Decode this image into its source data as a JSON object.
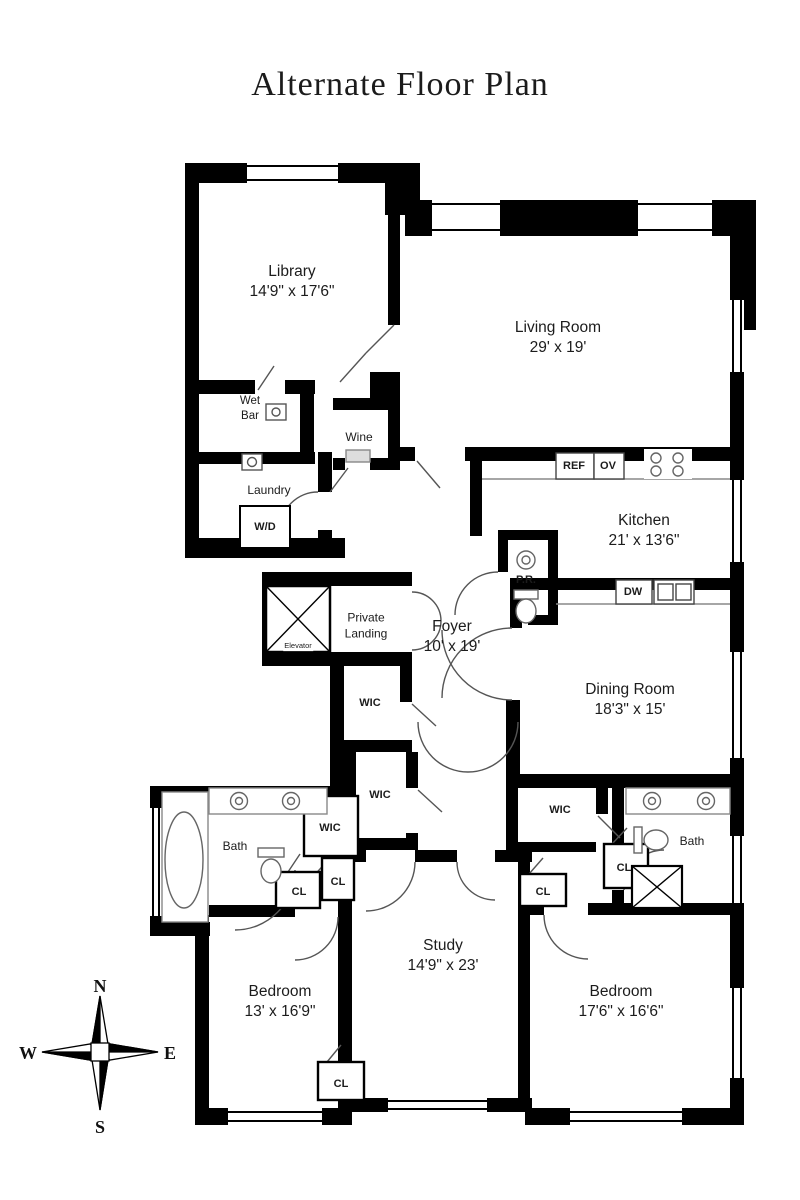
{
  "title": "Alternate Floor Plan",
  "rooms": {
    "library": {
      "name": "Library",
      "dims": "14'9\" x 17'6\""
    },
    "living_room": {
      "name": "Living Room",
      "dims": "29' x 19'"
    },
    "kitchen": {
      "name": "Kitchen",
      "dims": "21' x 13'6\""
    },
    "foyer": {
      "name": "Foyer",
      "dims": "10' x 19'"
    },
    "dining_room": {
      "name": "Dining Room",
      "dims": "18'3\" x 15'"
    },
    "study": {
      "name": "Study",
      "dims": "14'9\" x 23'"
    },
    "bedroom_left": {
      "name": "Bedroom",
      "dims": "13' x 16'9\""
    },
    "bedroom_right": {
      "name": "Bedroom",
      "dims": "17'6\" x 16'6\""
    }
  },
  "small_rooms": {
    "private_landing": "Private Landing",
    "elevator": "Elevator",
    "wet_bar": "Wet Bar",
    "laundry": "Laundry",
    "wine": "Wine",
    "wd": "W/D",
    "pr": "P.R.",
    "bath_left": "Bath",
    "bath_right": "Bath",
    "wic_upper": "WIC",
    "wic_middle": "WIC",
    "wic_left": "WIC",
    "wic_right": "WIC",
    "cl_left_1": "CL",
    "cl_left_2": "CL",
    "cl_right_1": "CL",
    "cl_right_2": "CL",
    "cl_bottom": "CL"
  },
  "appliances": {
    "ref": "REF",
    "ov": "OV",
    "dw": "DW"
  },
  "compass": {
    "north": "N",
    "south": "S",
    "east": "E",
    "west": "W"
  },
  "colors": {
    "wall": "#000000",
    "text": "#1c1c1c",
    "door_arc": "#555555",
    "fixture": "#7a7a7a"
  }
}
